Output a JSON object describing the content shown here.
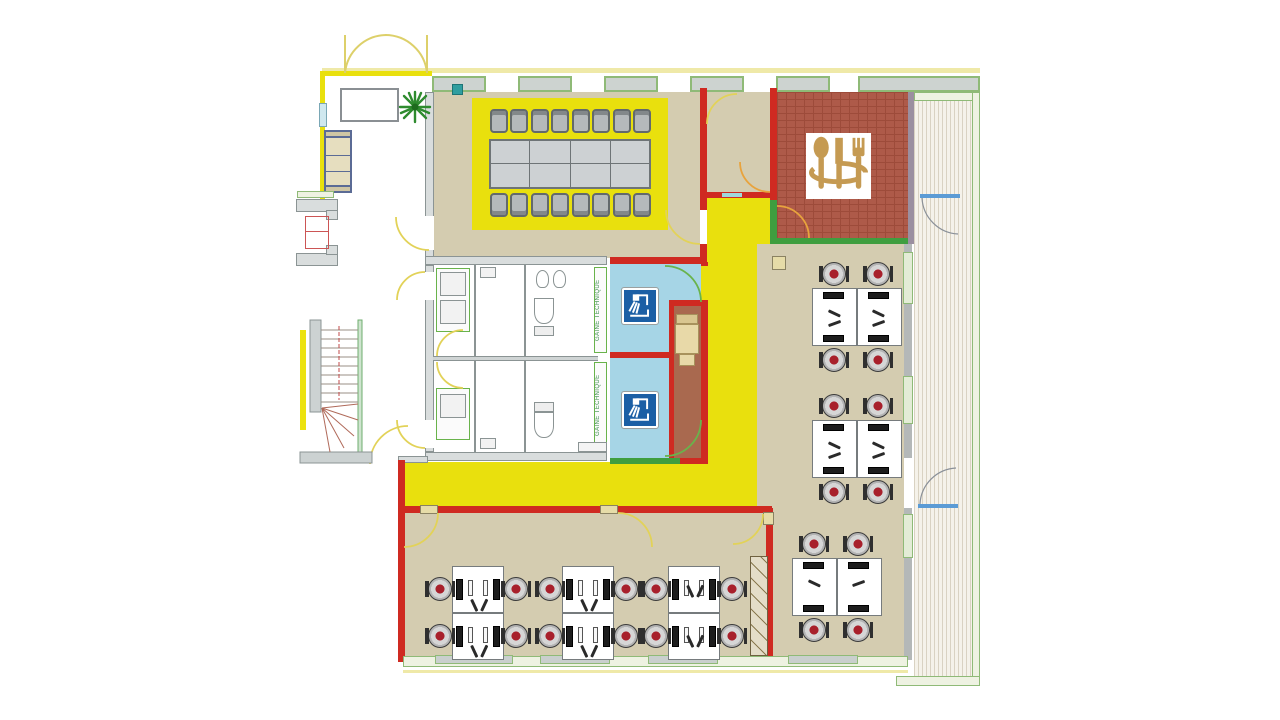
{
  "plan": {
    "type": "office-floor-plan",
    "labels": {
      "technical_duct_upper": "GAINE TECHNIQUE",
      "technical_duct_lower": "GAINE TECHNIQUE"
    },
    "icons": {
      "kitchen": "cutlery-icon",
      "shower_room_upper": "shower-icon",
      "shower_room_lower": "shower-icon",
      "lobby_plant": "plant-icon"
    },
    "zones": [
      {
        "name": "entrance-lobby"
      },
      {
        "name": "elevator"
      },
      {
        "name": "staircase"
      },
      {
        "name": "meeting-room",
        "seats": 16
      },
      {
        "name": "kitchen-dining"
      },
      {
        "name": "terrace"
      },
      {
        "name": "toilets"
      },
      {
        "name": "shower-rooms",
        "count": 2
      },
      {
        "name": "lounge-nook"
      },
      {
        "name": "corridor"
      },
      {
        "name": "open-space-right",
        "workstations": 12
      },
      {
        "name": "open-space-bottom",
        "workstations": 12
      }
    ],
    "palette": {
      "corridor_yellow": "#e9e00d",
      "wall_red": "#cf2a21",
      "floor_tan": "#d4ccb0",
      "kitchen_brick": "#ae5a49",
      "shower_blue": "#a6d5e6",
      "shower_icon_blue": "#1b5fa5",
      "lounge_brown": "#a9694f",
      "wall_green": "#3f9e3f",
      "window_green": "#8fba77",
      "cutlery_tan": "#c59a52",
      "chair_accent_red": "#a8202c"
    }
  }
}
